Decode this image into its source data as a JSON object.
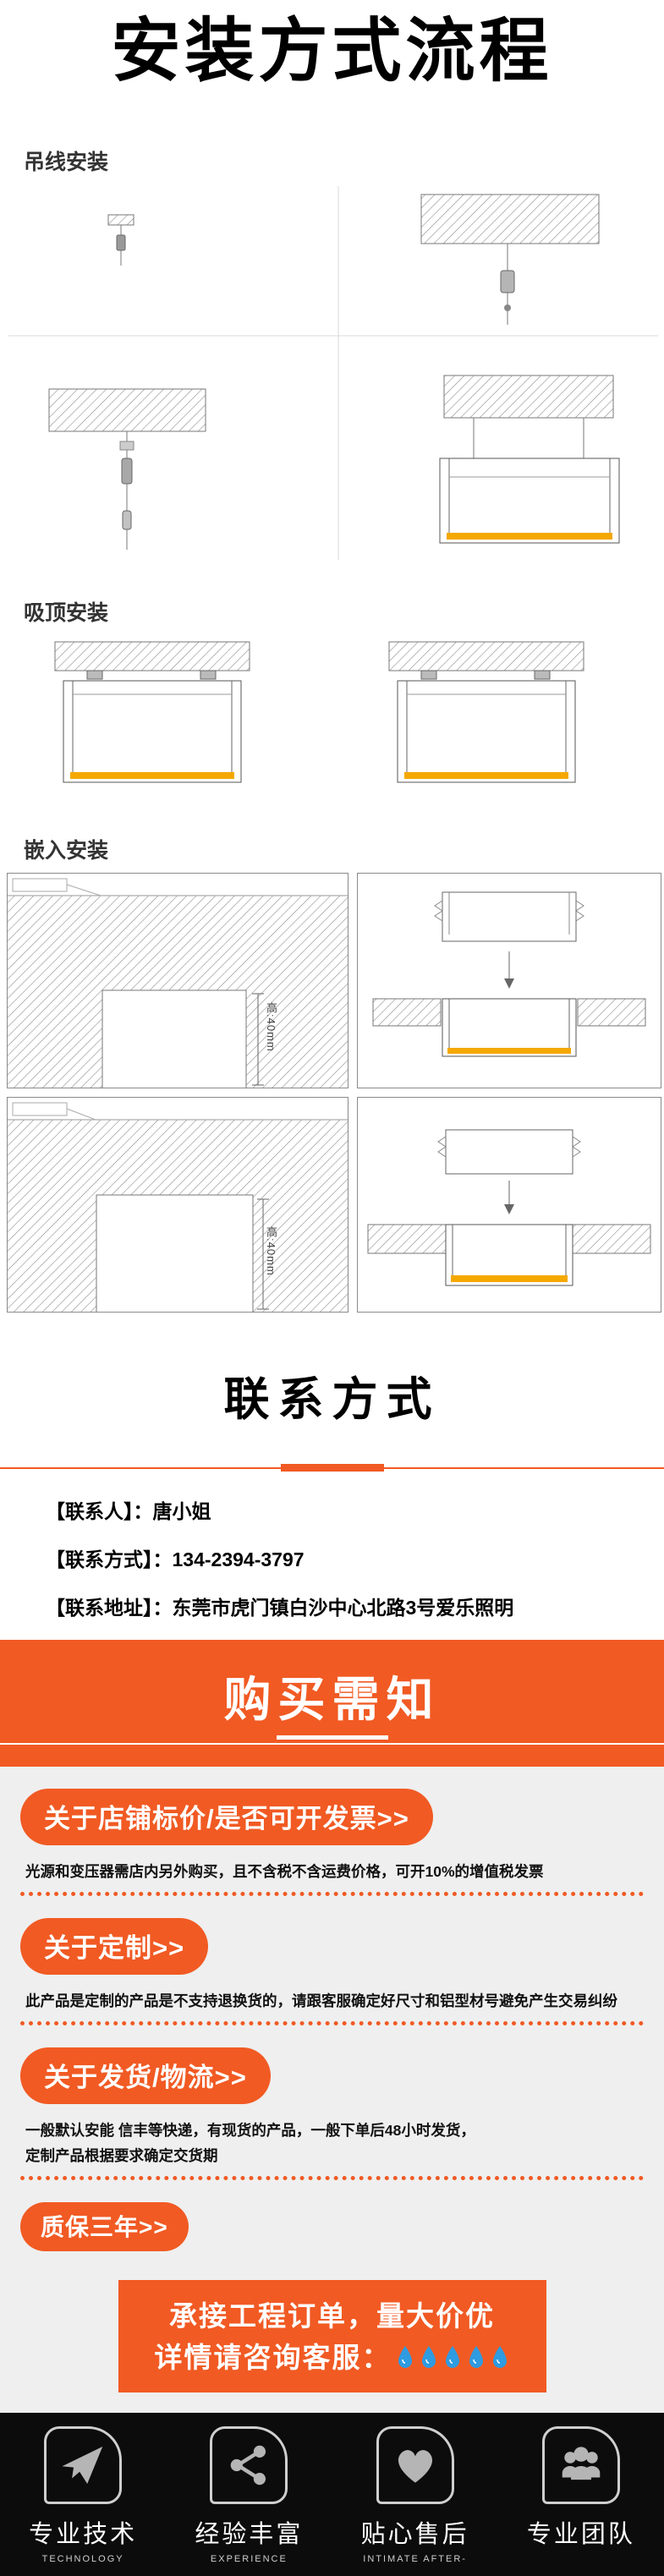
{
  "title": "安装方式流程",
  "install": {
    "hanging_label": "吊线安装",
    "ceiling_label": "吸顶安装",
    "recessed_label": "嵌入安装",
    "height_dim": "高:40mm"
  },
  "contact": {
    "title": "联系方式",
    "person_label": "【联系人】：",
    "person_value": "唐小姐",
    "phone_label": "【联系方式】：",
    "phone_value": "134-2394-3797",
    "address_label": "【联系地址】：",
    "address_value": "东莞市虎门镇白沙中心北路3号爱乐照明"
  },
  "notice": {
    "header": "购买需知",
    "items": [
      {
        "title": "关于店铺标价/是否可开发票>>",
        "body": "光源和变压器需店内另外购买，且不含税不含运费价格，可开10%的增值税发票",
        "body2": ""
      },
      {
        "title": "关于定制>>",
        "body": "此产品是定制的产品是不支持退换货的，请跟客服确定好尺寸和铝型材号避免产生交易纠纷",
        "body2": ""
      },
      {
        "title": "关于发货/物流>>",
        "body": "一般默认安能 信丰等快递，有现货的产品，一般下单后48小时发货，",
        "body2": "定制产品根据要求确定交货期"
      },
      {
        "title": "质保三年>>",
        "body": "",
        "body2": ""
      }
    ],
    "cta_line1": "承接工程订单，量大价优",
    "cta_line2": "详情请咨询客服："
  },
  "footer": {
    "items": [
      {
        "label": "专业技术",
        "sub": "TECHNOLOGY"
      },
      {
        "label": "经验丰富",
        "sub": "EXPERIENCE"
      },
      {
        "label": "贴心售后",
        "sub": "INTIMATE AFTER-"
      },
      {
        "label": "专业团队",
        "sub": ""
      }
    ]
  },
  "colors": {
    "accent": "#F15A23",
    "diffuser_yellow": "#F5A800",
    "footer_bg": "#0C0C0C",
    "notice_bg": "#EFEFEF"
  }
}
